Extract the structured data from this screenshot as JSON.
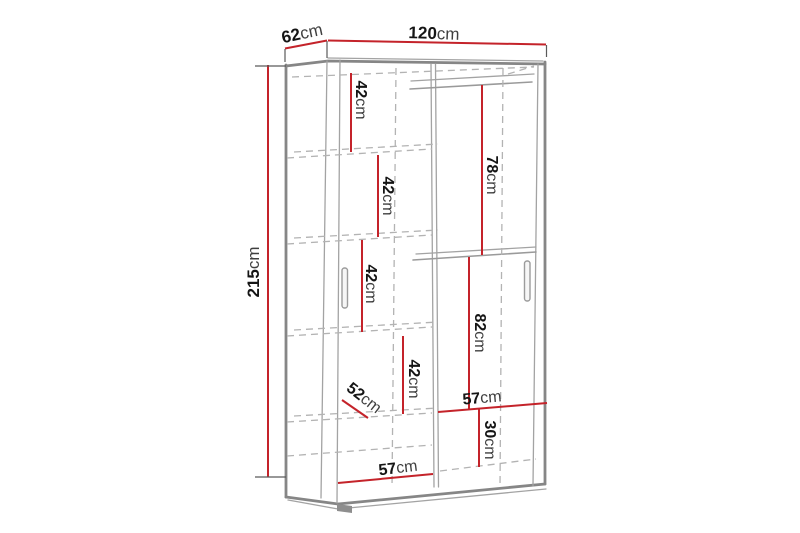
{
  "diagram": {
    "title": "wardrobe-dimension-diagram",
    "colors": {
      "dimension_line": "#c4232a",
      "carcass_line": "#868686",
      "hidden_line": "#b3b3b3",
      "digits": "#151515",
      "unit_text": "#3f3f3f",
      "background": "#ffffff"
    },
    "labels": {
      "width": {
        "value": "120",
        "unit": "cm"
      },
      "depth": {
        "value": "62",
        "unit": "cm"
      },
      "height": {
        "value": "215",
        "unit": "cm"
      },
      "compartment_1": {
        "value": "42",
        "unit": "cm"
      },
      "hanging_upper": {
        "value": "78",
        "unit": "cm"
      },
      "compartment_2": {
        "value": "42",
        "unit": "cm"
      },
      "compartment_3": {
        "value": "42",
        "unit": "cm"
      },
      "hanging_lower": {
        "value": "82",
        "unit": "cm"
      },
      "compartment_4": {
        "value": "42",
        "unit": "cm"
      },
      "shelf_depth": {
        "value": "52",
        "unit": "cm"
      },
      "inner_width_right": {
        "value": "57",
        "unit": "cm"
      },
      "bottom_section_height": {
        "value": "30",
        "unit": "cm"
      },
      "inner_width_left": {
        "value": "57",
        "unit": "cm"
      }
    }
  }
}
